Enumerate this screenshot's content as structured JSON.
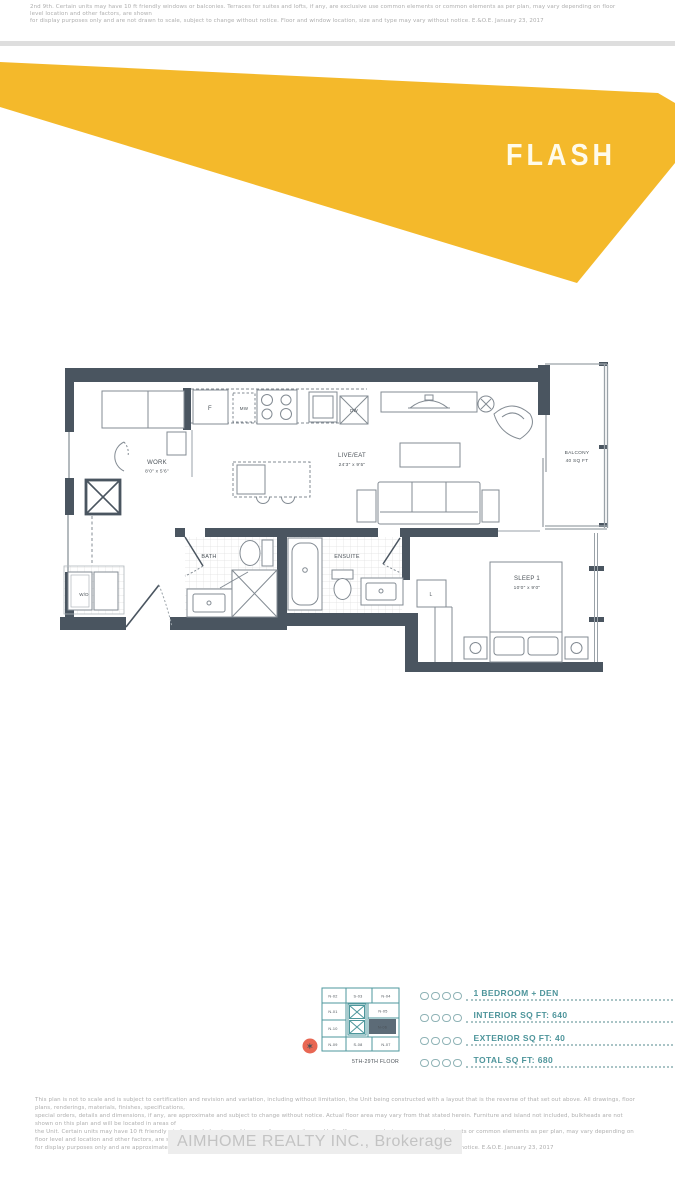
{
  "brand": {
    "flash_label": "FLASH",
    "yellow": "#F4B92B",
    "teal": "#4E979C",
    "wall_color": "#4A5560",
    "highlight_unit_color": "#5C6B77",
    "compass_color": "#E86753"
  },
  "top_disclaimer": {
    "line1": "2nd 9th. Certain units may have 10 ft friendly windows or balconies. Terraces for suites and lofts, if any, are exclusive use common elements or common elements as per plan, may vary depending on floor level location and other factors, are shown",
    "line2": "for display purposes only and are not drawn to scale, subject to change without notice. Floor and window location, size and type may vary without notice. E.&O.E. January 23, 2017"
  },
  "floor_plan": {
    "rooms": {
      "work": {
        "name": "WORK",
        "dims": "8'0\" x 5'6\""
      },
      "live_eat": {
        "name": "LIVE/EAT",
        "dims": "24'3\" x 9'5\""
      },
      "sleep": {
        "name": "SLEEP 1",
        "dims": "10'0\" x 9'0\""
      },
      "bath": {
        "name": "BATH"
      },
      "ensuite": {
        "name": "ENSUITE"
      },
      "balcony": {
        "name": "BALCONY",
        "area": "40 SQ FT"
      },
      "laundry": {
        "name": "W/D"
      },
      "closet": {
        "name": "L"
      }
    },
    "appliances": {
      "fridge": "F",
      "microwave": "MW",
      "dishwasher": "DW"
    }
  },
  "key_plan": {
    "units": {
      "n02": "N-02",
      "s03": "S-03",
      "n04": "N-04",
      "n01": "N-01",
      "n05": "N-05",
      "n10": "N-10",
      "n06": "N-06",
      "n09": "N-09",
      "s08": "S-08",
      "n07": "N-07"
    },
    "highlighted_unit": "N-06",
    "floor_range": "5TH-29TH FLOOR"
  },
  "unit_info": {
    "rows": [
      {
        "label": "1 BEDROOM + DEN"
      },
      {
        "label": "INTERIOR SQ FT: 640"
      },
      {
        "label": "EXTERIOR SQ FT: 40"
      },
      {
        "label": "TOTAL SQ FT: 680"
      }
    ]
  },
  "footer": {
    "disclaimer_lines": [
      "This plan is not to scale and is subject to certification and revision and variation, including without limitation, the Unit being constructed with a layout that is the reverse of that set out above. All drawings, floor plans, renderings, materials, finishes, specifications,",
      "special orders, details and dimensions, if any, are approximate and subject to change without notice. Actual floor area may vary from that stated herein. Furniture and island not included, bulkheads are not shown on this plan and will be located in areas of",
      "the Unit. Certain units may have 10 ft friendly windows or balconies and terraces for some suites and lofts. If any, are exclusive use common elements or common elements as per plan, may vary depending on floor level and location and other factors, are shown",
      "for display purposes only and are approximate and subject to change without notice. Floor and window location, size and type may vary from actual notice. E.&O.E. January 23, 2017"
    ],
    "brokerage": "AIMHOME REALTY INC., Brokerage"
  }
}
